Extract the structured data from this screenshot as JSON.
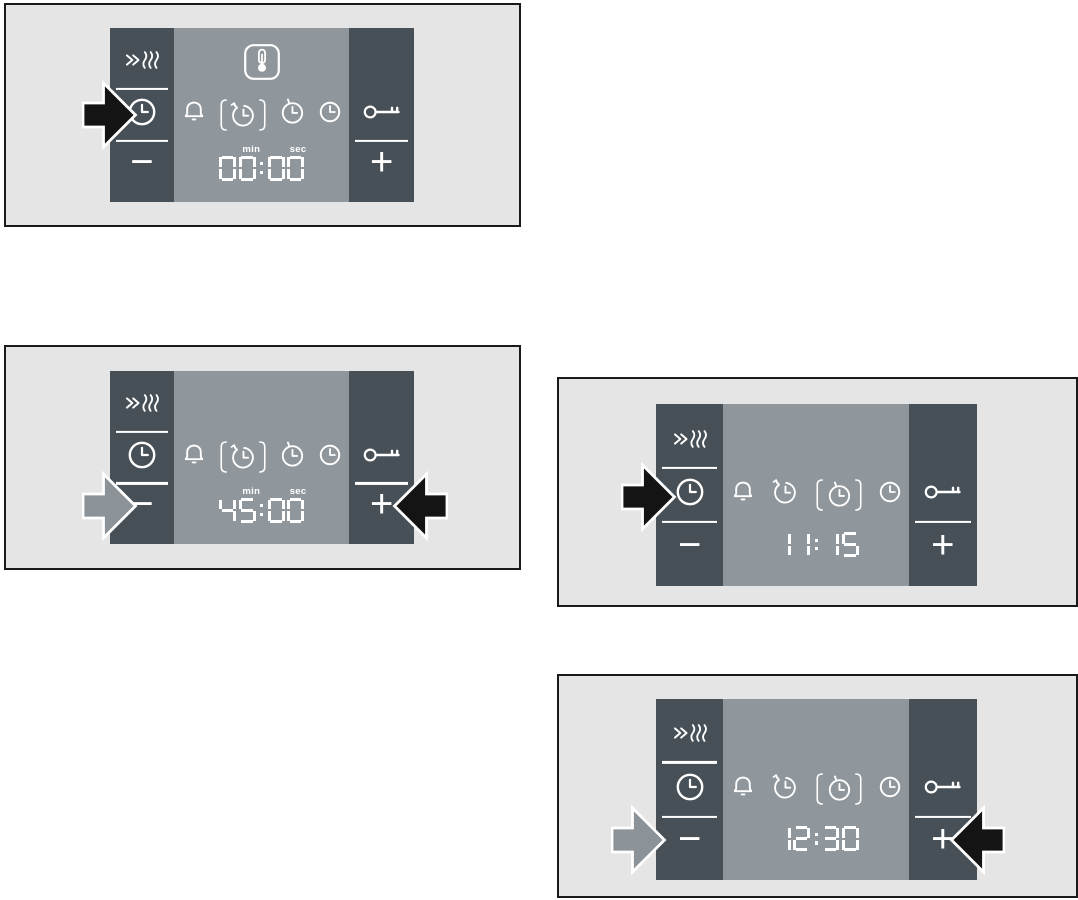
{
  "colors": {
    "page_bg": "#ffffff",
    "figure_bg": "#e5e5e5",
    "figure_border": "#1a1a1a",
    "panel_dark": "#475057",
    "panel_display": "#90979c",
    "glyph_white": "#ffffff",
    "arrow_black": "#141414",
    "arrow_gray": "#8b9298"
  },
  "icons": {
    "rapid_heat": "»≋",
    "timer": "clock-dial",
    "alarm_bell": "bell",
    "cooking_time": "clock-rotate-arrow",
    "end_time": "clock-tick",
    "time_of_day": "clock-dial",
    "key_lock": "key",
    "thermometer": "thermometer-in-frame",
    "minus": "−",
    "plus": "+"
  },
  "panels": [
    {
      "name": "cooking-time-initial",
      "display": {
        "time": "00:00",
        "min_label": "min",
        "sec_label": "sec"
      },
      "thermometer_shown": true,
      "highlighted_function": "cooking-time",
      "arrows": [
        {
          "color": "black",
          "direction": "right",
          "points_at": "timer-button"
        }
      ]
    },
    {
      "name": "cooking-time-45-minutes",
      "display": {
        "time": "45:00",
        "min_label": "min",
        "sec_label": "sec"
      },
      "thermometer_shown": false,
      "highlighted_function": "cooking-time",
      "arrows": [
        {
          "color": "gray",
          "direction": "right",
          "points_at": "minus-button"
        },
        {
          "color": "black",
          "direction": "left",
          "points_at": "plus-button"
        }
      ]
    },
    {
      "name": "clock-time-11-15",
      "display": {
        "time": "11:15"
      },
      "thermometer_shown": false,
      "highlighted_function": "end-time",
      "arrows": [
        {
          "color": "black",
          "direction": "right",
          "points_at": "timer-button"
        }
      ]
    },
    {
      "name": "clock-time-12-30",
      "display": {
        "time": "12:30"
      },
      "thermometer_shown": false,
      "highlighted_function": "end-time",
      "arrows": [
        {
          "color": "gray",
          "direction": "right",
          "points_at": "minus-button"
        },
        {
          "color": "black",
          "direction": "left",
          "points_at": "plus-button"
        }
      ]
    }
  ]
}
